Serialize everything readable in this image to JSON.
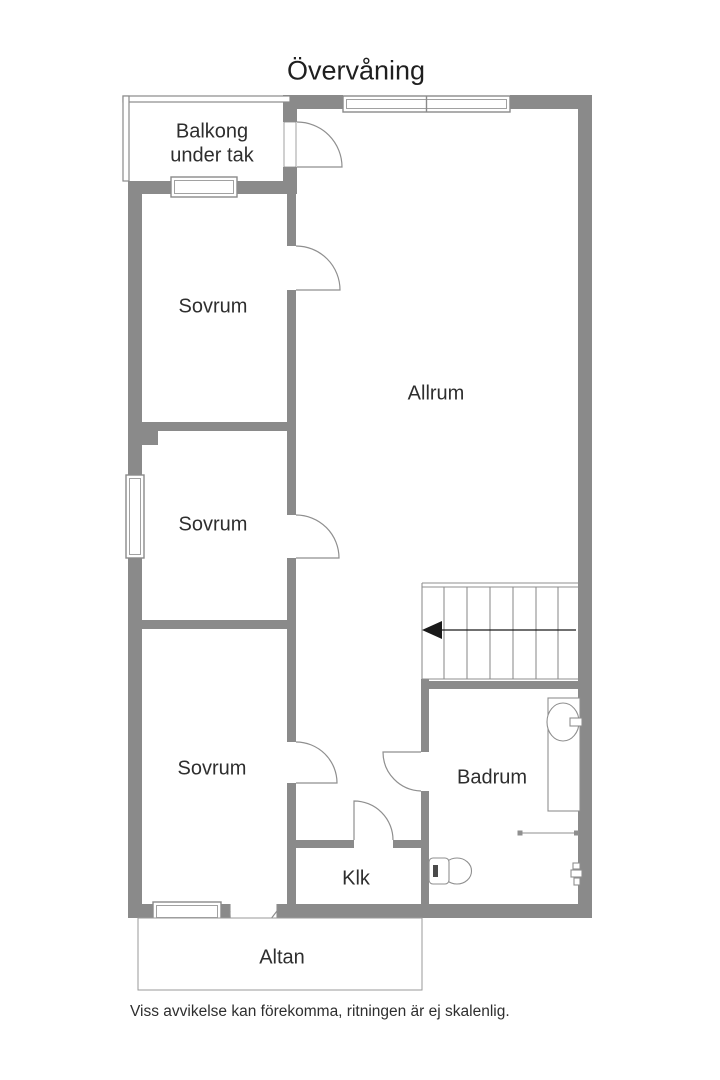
{
  "title": "Övervåning",
  "rooms": {
    "balkong": {
      "line1": "Balkong",
      "line2": "under tak"
    },
    "sovrum1": {
      "label": "Sovrum"
    },
    "sovrum2": {
      "label": "Sovrum"
    },
    "sovrum3": {
      "label": "Sovrum"
    },
    "allrum": {
      "label": "Allrum"
    },
    "badrum": {
      "label": "Badrum"
    },
    "klk": {
      "label": "Klk"
    },
    "altan": {
      "label": "Altan"
    }
  },
  "stairs": {
    "direction_arrow": "left"
  },
  "fixture_icons": [
    "toilet-icon",
    "sink-icon",
    "shower-rail-icon",
    "mixer-tap-icon"
  ],
  "footer": "Viss avvikelse kan förekomma, ritningen är ej skalenlig.",
  "colors": {
    "wall": "#8a8a8a",
    "line": "#8f8f8f",
    "text": "#2e2e2e",
    "arrow": "#1a1a1a"
  }
}
